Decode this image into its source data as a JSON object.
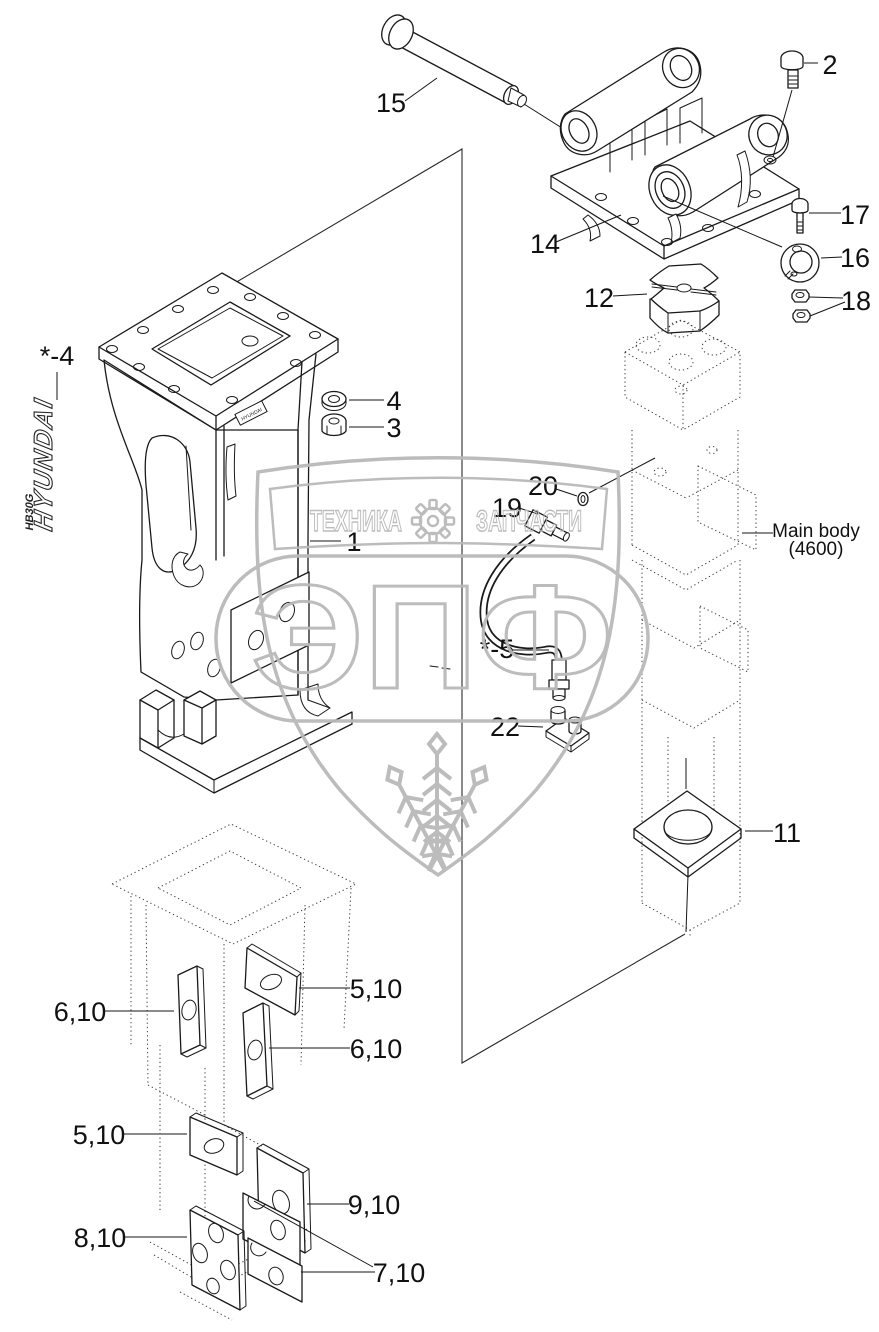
{
  "labels": {
    "n15": "15",
    "n2": "2",
    "n14": "14",
    "n17": "17",
    "n16": "16",
    "n18": "18",
    "n12": "12",
    "n4": "4",
    "n3": "3",
    "n1": "1",
    "ref4": "*-4",
    "n20": "20",
    "n19": "19",
    "ref5": "*-5",
    "n22": "22",
    "n11": "11",
    "n5_10": "5,10",
    "n6_10": "6,10",
    "n7_10": "7,10",
    "n8_10": "8,10",
    "n9_10": "9,10"
  },
  "main_body": {
    "name": "Main body",
    "code": "(4600)"
  },
  "decal": {
    "brand": "HYUNDAI",
    "model": "HB30G"
  },
  "watermark": {
    "word_left": "ТЕХНИКА",
    "word_right": "ЗАПЧАСТИ",
    "acronym": "ЭПФ"
  },
  "colors": {
    "line": "#1a1a1a",
    "watermark": "#b9b9b9",
    "background": "#ffffff"
  }
}
